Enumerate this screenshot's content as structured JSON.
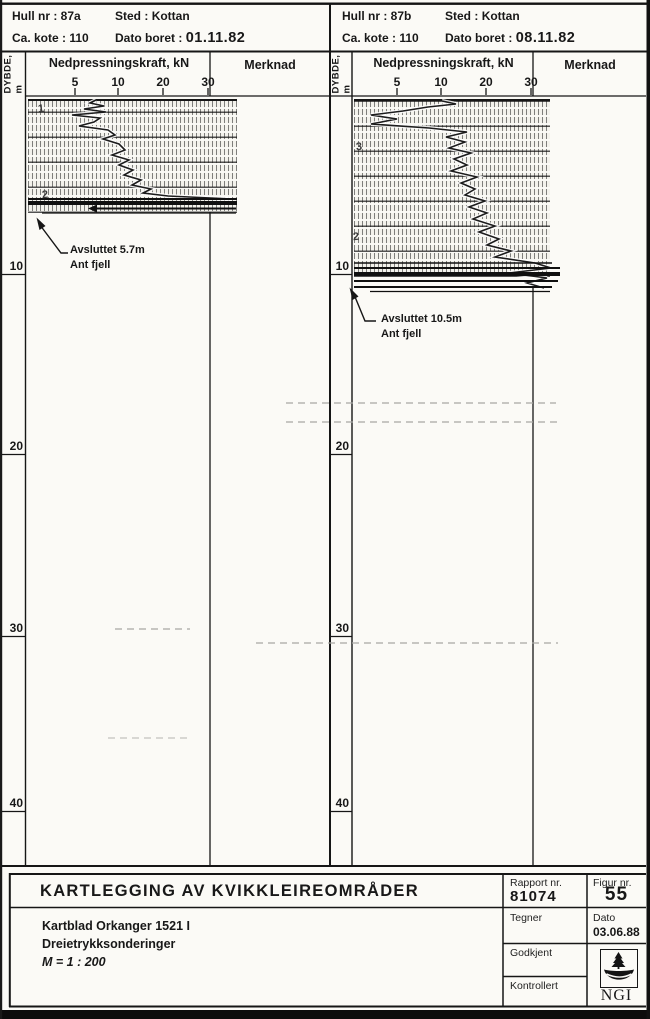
{
  "panels": [
    {
      "id": "87a",
      "header": {
        "hull_label": "Hull nr :",
        "hull_value": "87a",
        "sted_label": "Sted :",
        "sted_value": "Kottan",
        "kote_label": "Ca. kote :",
        "kote_value": "110",
        "dato_label": "Dato boret :",
        "dato_value": "01.11.82"
      },
      "axis": {
        "depth_label": "DYBDE, m",
        "force_label": "Nedpressningskraft, kN",
        "note_label": "Merknad",
        "force_ticks": [
          "5",
          "10",
          "20",
          "30"
        ]
      },
      "depth_ticks": [
        "10",
        "20",
        "30",
        "40"
      ],
      "marks": [
        "1",
        "2"
      ],
      "annotation": {
        "line1": "Avsluttet 5.7m",
        "line2": "Ant fjell"
      },
      "trace_points": "96,100 90,103 104,106 84,109 106,112 72,115 100,118 94,122 79,126 108,130 115,135 103,139 119,144 125,150 112,155 129,160 119,165 133,170 124,175 141,180 132,185 151,189 143,193 168,196 232,199"
    },
    {
      "id": "87b",
      "header": {
        "hull_label": "Hull nr :",
        "hull_value": "87b",
        "sted_label": "Sted :",
        "sted_value": "Kottan",
        "kote_label": "Ca. kote :",
        "kote_value": "110",
        "dato_label": "Dato boret :",
        "dato_value": "08.11.82"
      },
      "axis": {
        "depth_label": "DYBDE, m",
        "force_label": "Nedpressningskraft, kN",
        "note_label": "Merknad",
        "force_ticks": [
          "5",
          "10",
          "20",
          "30"
        ]
      },
      "depth_ticks": [
        "10",
        "20",
        "30",
        "40"
      ],
      "marks": [
        "3",
        "2"
      ],
      "annotation": {
        "line1": "Avsluttet 10.5m",
        "line2": "Ant fjell"
      },
      "trace_points": "442,101 456,104 428,107 403,111 371,115 397,119 371,124 429,128 467,132 446,137 465,142 449,148 471,153 454,159 467,165 451,171 477,177 461,183 475,189 465,195 485,201 469,207 487,213 473,219 495,226 479,232 499,239 487,245 511,251 495,257 535,263 551,268 509,273 547,278 527,283 544,288"
    }
  ],
  "title_block": {
    "title": "KARTLEGGING AV KVIKKLEIREOMRÅDER",
    "subtitle_lines": [
      "Kartblad Orkanger 1521 I",
      "Dreietrykksonderinger",
      "M = 1 : 200"
    ],
    "rapport_label": "Rapport nr.",
    "rapport_value": "81074",
    "figur_label": "Figur nr.",
    "figur_value": "55",
    "tegner_label": "Tegner",
    "dato_label": "Dato",
    "dato_value": "03.06.88",
    "godkjent_label": "Godkjent",
    "kontrollert_label": "Kontrollert",
    "logo_text": "NGI"
  },
  "chart_data": [
    {
      "type": "line",
      "title": "Dreietrykksondering hull 87a",
      "xlabel": "Nedpressningskraft, kN",
      "ylabel": "Dybde, m",
      "x_ticks": [
        5,
        10,
        20,
        30
      ],
      "y_range": [
        0,
        43
      ],
      "terminated_depth_m": 5.7,
      "termination_note": "Ant fjell"
    },
    {
      "type": "line",
      "title": "Dreietrykksondering hull 87b",
      "xlabel": "Nedpressningskraft, kN",
      "ylabel": "Dybde, m",
      "x_ticks": [
        5,
        10,
        20,
        30
      ],
      "y_range": [
        0,
        43
      ],
      "terminated_depth_m": 10.5,
      "termination_note": "Ant fjell"
    }
  ]
}
